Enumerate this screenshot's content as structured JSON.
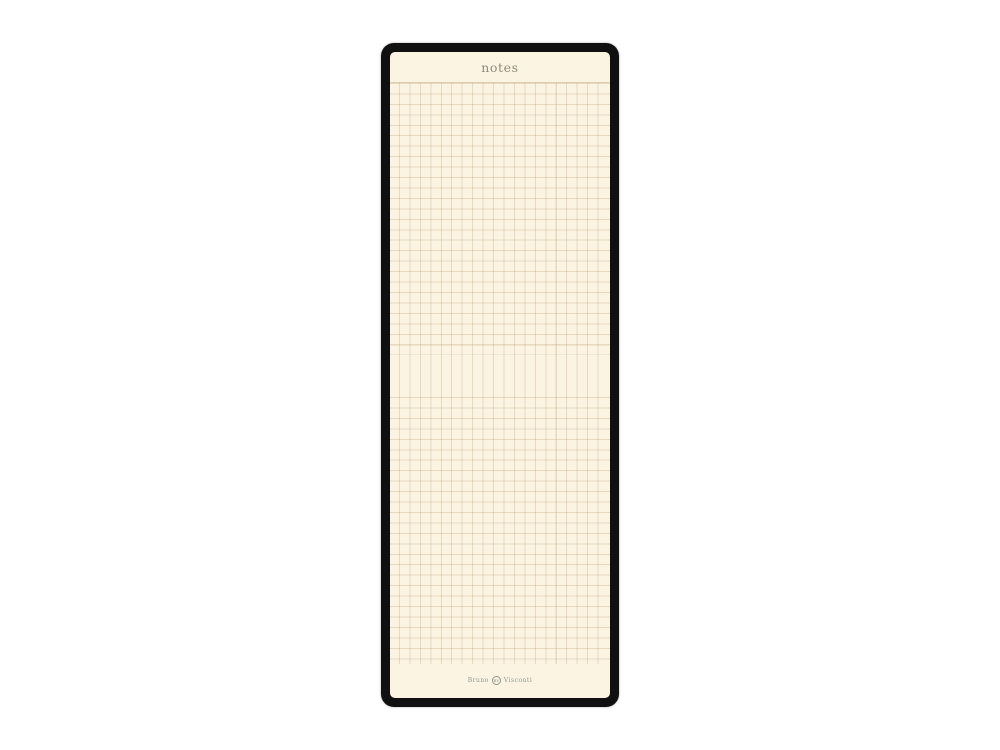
{
  "pad": {
    "title": "notes",
    "brand": {
      "left": "Bruno",
      "emblem": "BV",
      "right": "Visconti"
    }
  },
  "theme": {
    "pageBg": "#ffffff",
    "frame": "#101010",
    "paper": "#fbf4e3",
    "gridLine": "rgba(190,160,118,0.33)",
    "gridStrong": "#dccfb3",
    "titleColor": "#8f8b7d",
    "brandColor": "#8f968b"
  }
}
